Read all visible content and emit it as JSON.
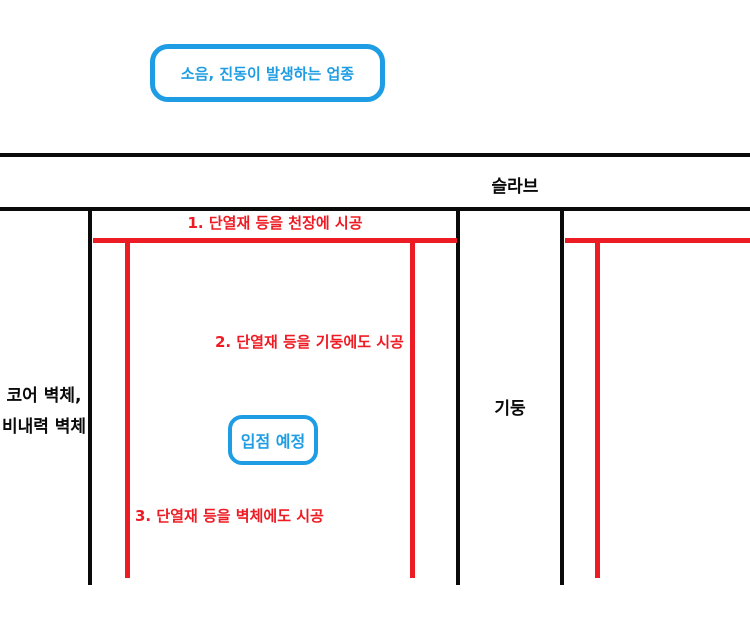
{
  "colors": {
    "accent_blue": "#1e9de4",
    "line_red": "#ed1c24",
    "line_black": "#0a0a0a"
  },
  "callouts": {
    "noise": "소음, 진동이 발생하는 업종",
    "tenant": "입점 예정"
  },
  "labels": {
    "slab": "슬라브",
    "core_wall_line1": "코어 벽체,",
    "core_wall_line2": "비내력 벽체",
    "column": "기둥"
  },
  "annotations": {
    "step1": "1. 단열재 등을 천장에 시공",
    "step2": "2. 단열재 등을 기둥에도 시공",
    "step3": "3. 단열재 등을 벽체에도 시공"
  }
}
